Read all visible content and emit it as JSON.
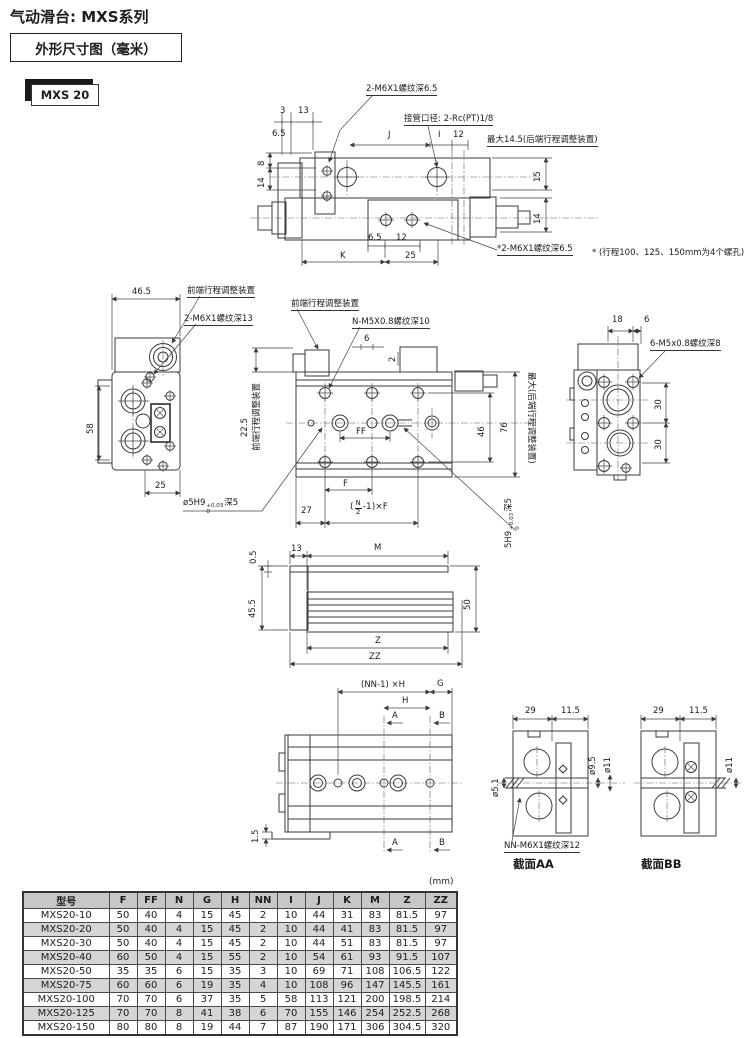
{
  "header": {
    "title": "气动滑台: MXS系列",
    "subtitle": "外形尺寸图（毫米）",
    "model": "MXS 20"
  },
  "colors": {
    "line": "#3a3a3a",
    "text": "#1b1b1b",
    "table_header_bg": "#c7c7c7",
    "table_alt_bg": "#d5d5d5"
  },
  "top_view": {
    "thread_note_top": "2-M6X1螺纹深6.5",
    "port_note": "接管口径: 2-Rc(PT)1/8",
    "max_note": "最大14.5(后端行程调整装置)",
    "thread_note_bottom": "*2-M6X1螺纹深6.5",
    "holes_note": "* (行程100、125、150mm为4个螺孔)",
    "dims": {
      "d3": "3",
      "d13": "13",
      "d65_top": "6.5",
      "dJ": "J",
      "dI": "I",
      "d12_top": "12",
      "d15": "15",
      "d14_right": "14",
      "d8": "8",
      "d14_left": "14",
      "d65_bot": "6.5",
      "d12_bot": "12",
      "dK": "K",
      "d25": "25"
    }
  },
  "left_view": {
    "adjuster_note": "前端行程调整装置",
    "thread_note": "2-M6X1螺纹深13",
    "dims": {
      "d465": "46.5",
      "d58": "58",
      "d25": "25"
    }
  },
  "plan_view": {
    "adjuster_note": "前端行程调整装置",
    "thread_note": "N-M5X0.8螺纹深10",
    "adjuster_left_vert": "前端行程调整装置",
    "adjuster_right_vert": "最大(后端行程调整装置)",
    "pin_note": {
      "prefix": "ø5H9",
      "tol_top": "+0.03",
      "tol_bot": "0",
      "suffix": "深5"
    },
    "pin_note_vert": {
      "prefix": "5H9",
      "tol_top": "+0.03",
      "tol_bot": "0",
      "suffix": "深5"
    },
    "formula": {
      "open": "(",
      "num": "N",
      "den": "2",
      "tail": "-1)×F"
    },
    "dims": {
      "d6": "6",
      "d2": "2",
      "dFF": "FF",
      "dF": "F",
      "d27": "27",
      "d46": "46",
      "d76": "76",
      "d225": "22.5"
    }
  },
  "end_view": {
    "thread_note": "6-M5x0.8螺纹深8",
    "dims": {
      "d18": "18",
      "d6": "6",
      "d30a": "30",
      "d30b": "30"
    }
  },
  "side_view": {
    "dims": {
      "d05": "0.5",
      "d13": "13",
      "dM": "M",
      "d455": "45.5",
      "d50": "50",
      "dZ": "Z",
      "dZZ": "ZZ"
    }
  },
  "bottom_view": {
    "dims": {
      "dNN": "(NN-1) ×H",
      "dG": "G",
      "dH": "H",
      "dA_top": "A",
      "dB_top": "B",
      "dA_bot": "A",
      "dB_bot": "B",
      "d15": "1.5"
    }
  },
  "section_aa": {
    "caption": "截面AA",
    "thread_note": "NN-M6X1螺纹深12",
    "dims": {
      "d29": "29",
      "d115": "11.5",
      "d51": "ø5.1",
      "d95": "ø9.5",
      "d11": "ø11"
    }
  },
  "section_bb": {
    "caption": "截面BB",
    "dims": {
      "d29": "29",
      "d115": "11.5",
      "d11": "ø11"
    }
  },
  "table": {
    "unit": "(mm)",
    "headers": [
      "型号",
      "F",
      "FF",
      "N",
      "G",
      "H",
      "NN",
      "I",
      "J",
      "K",
      "M",
      "Z",
      "ZZ"
    ],
    "rows": [
      [
        "MXS20-10",
        "50",
        "40",
        "4",
        "15",
        "45",
        "2",
        "10",
        "44",
        "31",
        "83",
        "81.5",
        "97"
      ],
      [
        "MXS20-20",
        "50",
        "40",
        "4",
        "15",
        "45",
        "2",
        "10",
        "44",
        "41",
        "83",
        "81.5",
        "97"
      ],
      [
        "MXS20-30",
        "50",
        "40",
        "4",
        "15",
        "45",
        "2",
        "10",
        "44",
        "51",
        "83",
        "81.5",
        "97"
      ],
      [
        "MXS20-40",
        "60",
        "50",
        "4",
        "15",
        "55",
        "2",
        "10",
        "54",
        "61",
        "93",
        "91.5",
        "107"
      ],
      [
        "MXS20-50",
        "35",
        "35",
        "6",
        "15",
        "35",
        "3",
        "10",
        "69",
        "71",
        "108",
        "106.5",
        "122"
      ],
      [
        "MXS20-75",
        "60",
        "60",
        "6",
        "19",
        "35",
        "4",
        "10",
        "108",
        "96",
        "147",
        "145.5",
        "161"
      ],
      [
        "MXS20-100",
        "70",
        "70",
        "6",
        "37",
        "35",
        "5",
        "58",
        "113",
        "121",
        "200",
        "198.5",
        "214"
      ],
      [
        "MXS20-125",
        "70",
        "70",
        "8",
        "41",
        "38",
        "6",
        "70",
        "155",
        "146",
        "254",
        "252.5",
        "268"
      ],
      [
        "MXS20-150",
        "80",
        "80",
        "8",
        "19",
        "44",
        "7",
        "87",
        "190",
        "171",
        "306",
        "304.5",
        "320"
      ]
    ]
  }
}
